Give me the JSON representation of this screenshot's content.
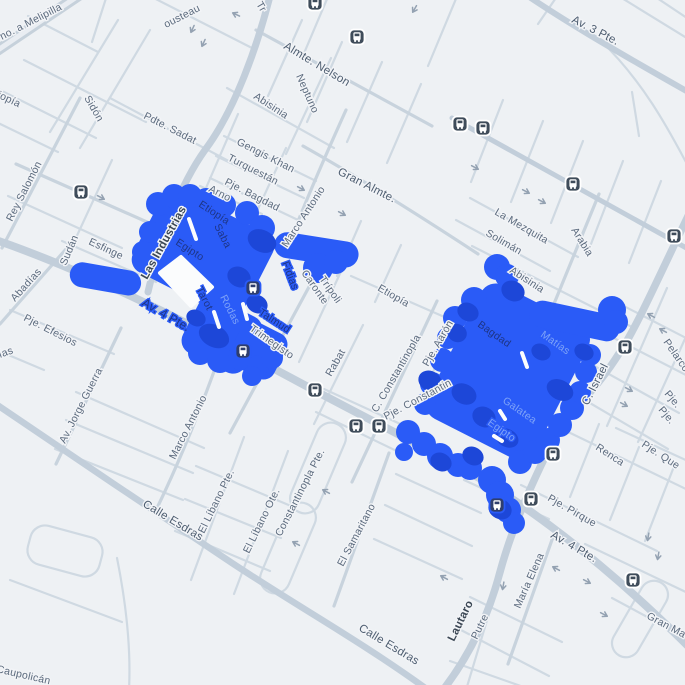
{
  "map": {
    "type": "street-map",
    "highlight": {
      "color": "#2a5bf7",
      "dark_spot_color": "#1d47d8",
      "area_count": 2
    },
    "colors": {
      "background": "#eef1f4",
      "road_minor": "#cfd9e2",
      "road_major": "#c2ceda",
      "label": "#5b6a7d",
      "label_dark": "#3c4855",
      "label_on_highlight_dark": "#1e3585",
      "label_on_highlight_light": "#7ea3f8",
      "bus_icon": "#3f4c5a",
      "arrow": "#94a2b2"
    },
    "icons": {
      "bus_stop": "bus-stop-icon",
      "bus_stop_count": 17,
      "one_way_arrow_count": 23
    },
    "labels": {
      "no_a_melipilla": "no. a Melipilla",
      "cousteau": "ousteau",
      "tr_fragment": "Tr",
      "almte_nelson": "Almte. Nelson",
      "av_3_pte": "Av. 3 Pte.",
      "neptuno": "Neptuno",
      "abisinia_north": "Abisinia",
      "tiopia": "tiopía",
      "sidon": "Sidón",
      "pdte_sadat": "Pdte. Sadat",
      "rey_salomon": "Rey Salomón",
      "gengis_khan": "Gengis Khan",
      "turquestan": "Turquestán",
      "pje_bagdad_north": "Pje. Bagdad",
      "arno": "Arno",
      "gran_almte": "Gran Almte.",
      "la_mezquita": "La Mezquita",
      "soliman": "Solimán",
      "arabia": "Arabia",
      "sudan": "Sudán",
      "esfinge": "Esfinge",
      "las_industrias": "Las Industrias",
      "marco_antonio_upper": "Marco Antonio",
      "etiopia_on_blue": "Etiopía",
      "saba": "Saba",
      "egipto_left": "Egipto",
      "av_4_pte_on_blue": "Av. 4 Pte.",
      "tarot": "Tarot",
      "rodas": "Rodas",
      "fidias": "Fidias",
      "caronte": "Caronte",
      "tripoli": "Trípoli",
      "etiopia_center": "Etiopía",
      "talmud": "Talmud",
      "trimegisto": "Trimegisto",
      "rabat": "Rabat",
      "c_constantinopla": "C. Constantinopla",
      "pje_aaron": "Pje. Aarón",
      "pje_constantin": "Pje. Constantin",
      "abisinia_right": "Abisinia",
      "bagdad_right": "Bagdad",
      "matias": "Matías",
      "galatea": "Galatea",
      "egipto_right": "Egipto",
      "c_israel": "C. Israel",
      "pelarco": "Pelarco",
      "pje_right_1": "Pje.",
      "pje_right_2": "Pje.",
      "renca": "Renca",
      "pje_que": "Pje. Que",
      "pje_pirque": "Pje. Pirque",
      "av_4_pte_south": "Av. 4 Pte.",
      "maria_elena": "María Elena",
      "lautaro": "Lautaro",
      "putre": "Putre",
      "calle_esdras_mid": "Calle Esdras",
      "calle_esdras_south": "Calle Esdras",
      "gran_ma": "Gran Ma",
      "caupolican": "Caupolicán",
      "el_libano_pte": "El Líbano Pte.",
      "el_libano_ote": "El Líbano Ote.",
      "constantinopla_pte": "Constantinopla Pte.",
      "el_samaritano": "El Samaritano",
      "av_jorge_guerra": "Av. Jorge Guerra",
      "marco_antonio_lower": "Marco Antonio",
      "ias_fragment": "ías",
      "pje_efesios": "Pje. Efesios",
      "abadias": "Abadías"
    }
  }
}
